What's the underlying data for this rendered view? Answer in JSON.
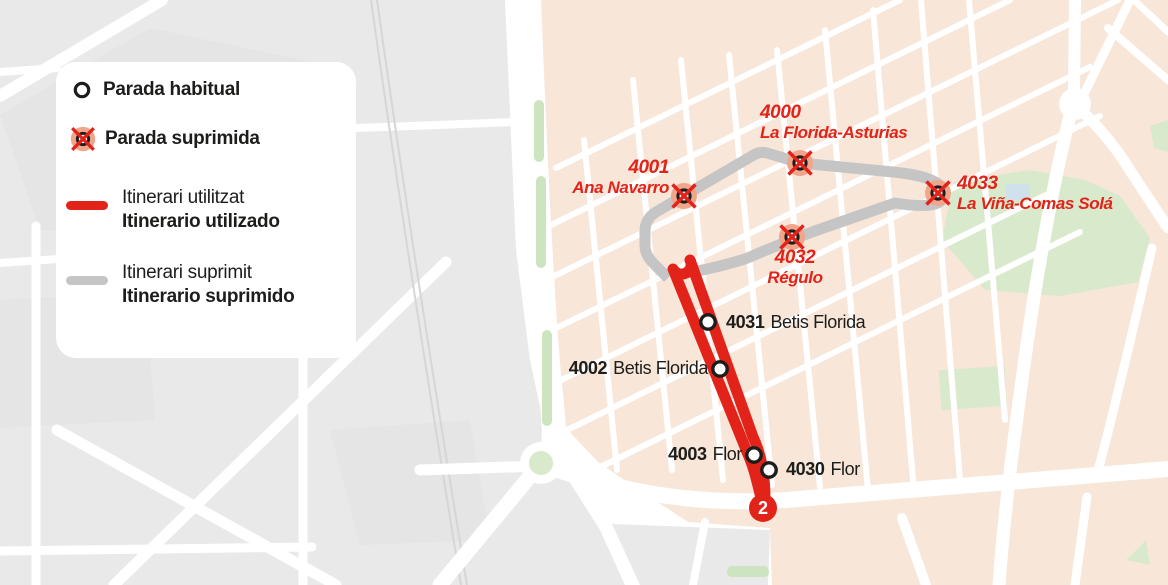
{
  "legend": {
    "habitual": "Parada habitual",
    "suprimida": "Parada suprimida",
    "used": {
      "cat": "Itinerari utilitzat",
      "es": "Itinerario utilizado"
    },
    "removed": {
      "cat": "Itinerari suprimit",
      "es": "Itinerario suprimido"
    }
  },
  "stops": {
    "suppressed": [
      {
        "code": "4000",
        "name": "La Florida-Asturias"
      },
      {
        "code": "4001",
        "name": "Ana Navarro"
      },
      {
        "code": "4033",
        "name": "La Viña-Comas Solá"
      },
      {
        "code": "4032",
        "name": "Régulo"
      }
    ],
    "regular": [
      {
        "code": "4031",
        "name": "Betis Florida"
      },
      {
        "code": "4002",
        "name": "Betis Florida"
      },
      {
        "code": "4003",
        "name": "Flor"
      },
      {
        "code": "4030",
        "name": "Flor"
      }
    ]
  },
  "line_badge": "2",
  "colors": {
    "route_used": "#e2231a",
    "route_removed": "#c5c5c5",
    "label_red": "#e2231a",
    "label_black": "#1d1d1b",
    "map_blocks_left": "#e9e9e9",
    "map_blocks_right": "#f8e6d8",
    "park_green": "#d9e9cc",
    "marker_halo": "#f1a58b",
    "street": "#ffffff"
  }
}
